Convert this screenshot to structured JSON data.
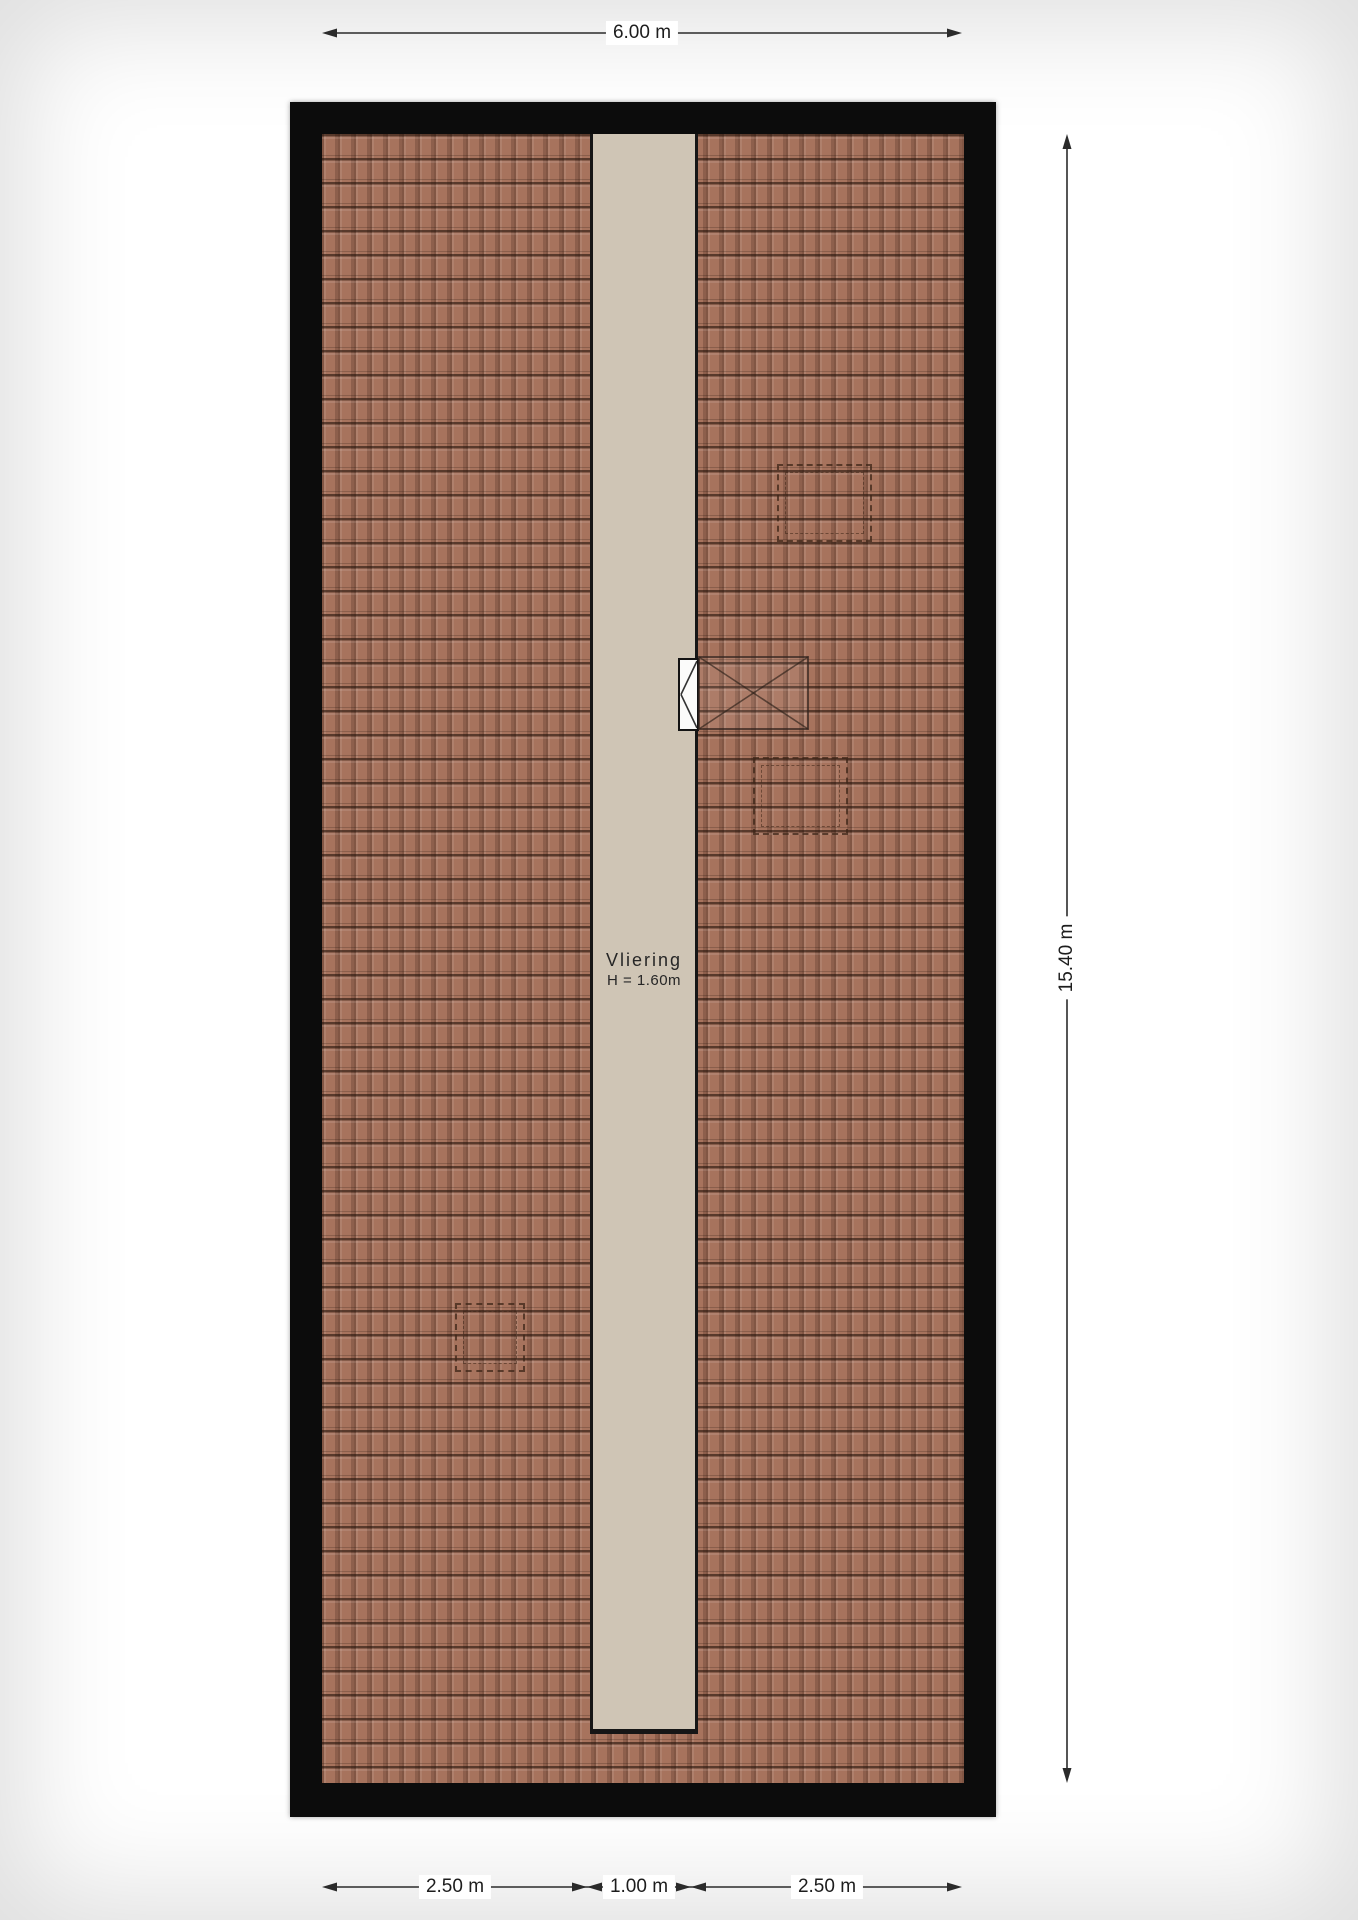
{
  "room": {
    "name": "Vliering",
    "height": "H = 1.60m"
  },
  "dimensions": {
    "top_width": "6.00 m",
    "right_height": "15.40 m",
    "bottom_left": "2.50 m",
    "bottom_middle": "1.00 m",
    "bottom_right": "2.50 m"
  },
  "symbols": {
    "roof_window": "roof-window-x-symbol",
    "loft_hatch": "hatch-triangle-symbol",
    "dashed_outlines": [
      "top-right",
      "middle-right",
      "bottom-left"
    ]
  },
  "colors": {
    "wall": "#0c0c0c",
    "roof_tile": "#a7735d",
    "roof_tile_line": "#54392e",
    "loft_floor": "#cfc5b5",
    "dimension_line": "#2b2b2b",
    "background": "#ffffff"
  }
}
